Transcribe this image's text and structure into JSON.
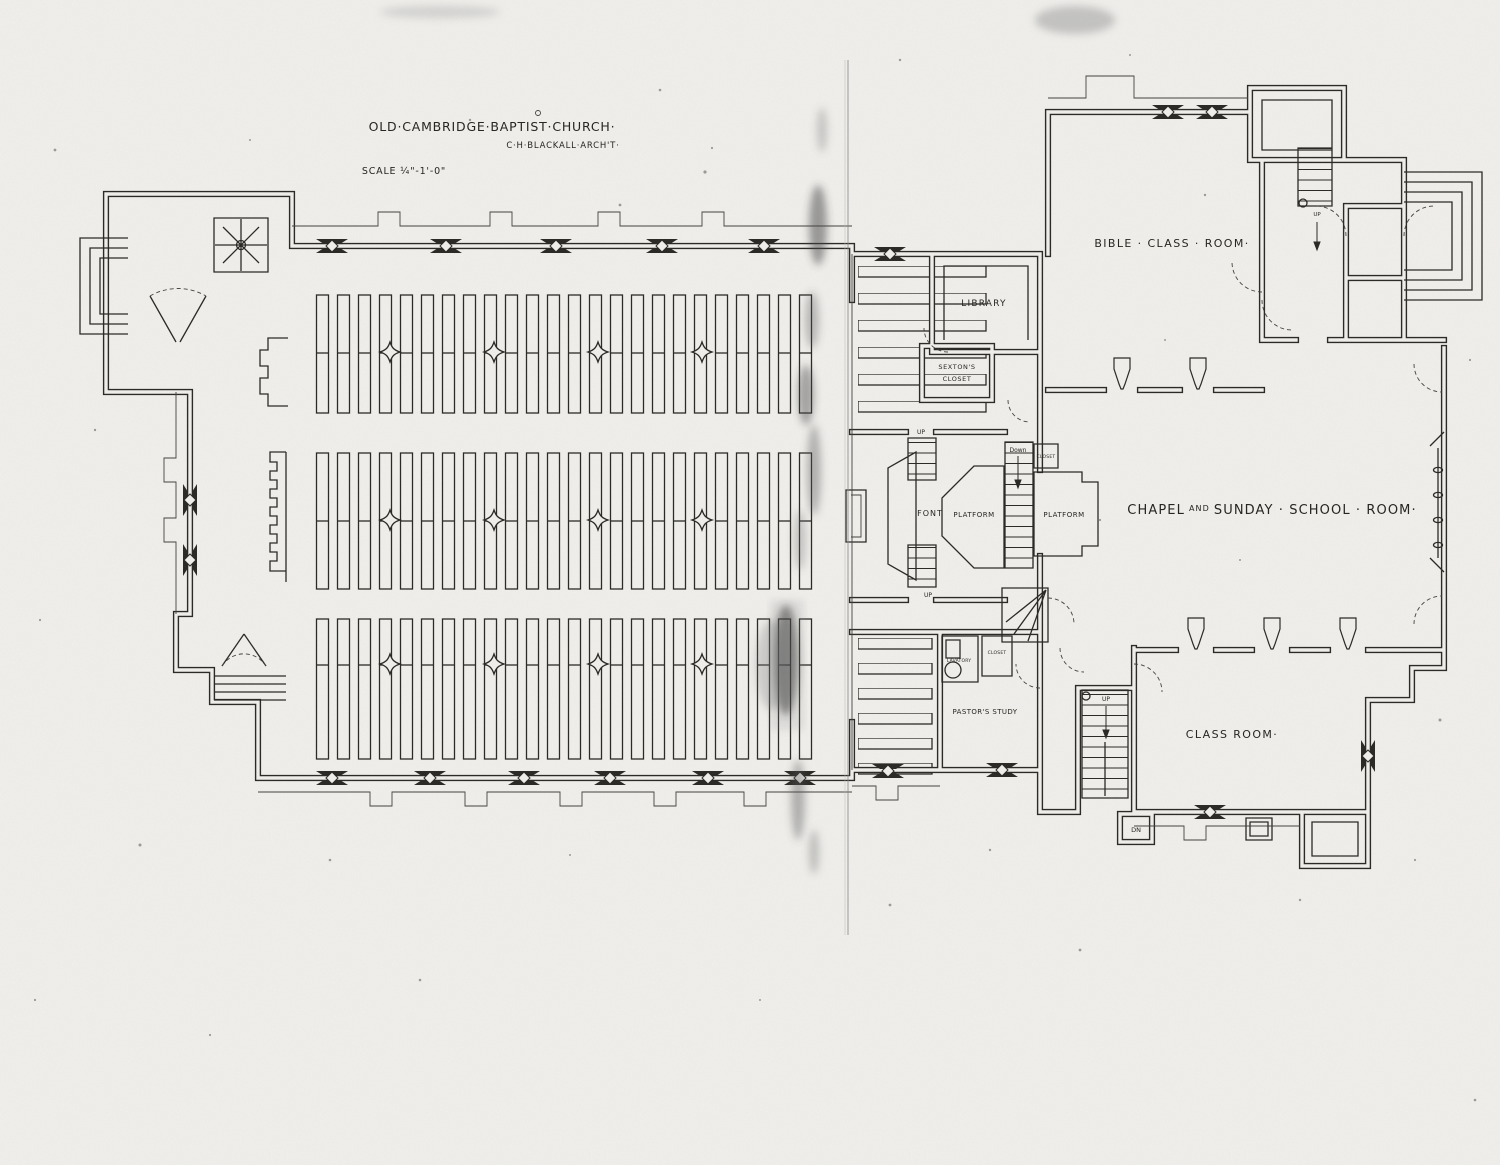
{
  "sheet": {
    "title": "OLD·CAMBRIDGE·BAPTIST·CHURCH·",
    "architect": "C·H·BLACKALL·ARCH'T·",
    "scale": "SCALE ¼\"-1'-0\""
  },
  "rooms": {
    "bible_class_room": "BIBLE · CLASS · ROOM·",
    "library": "LIBRARY",
    "sextons_closet_line1": "SEXTON'S",
    "sextons_closet_line2": "CLOSET",
    "font": "FONT",
    "platform_left": "PLATFORM",
    "platform_right": "PLATFORM",
    "chapel_word1": "CHAPEL",
    "chapel_word_and": "AND",
    "chapel_word2": "SUNDAY · SCHOOL · ROOM·",
    "pastors_study": "PASTOR'S STUDY",
    "class_room": "CLASS ROOM·",
    "lavatory": "LAVATORY",
    "closet_by_lavatory": "CLOSET",
    "closet_chancel": "CLOSET"
  },
  "stairs": {
    "up": "UP",
    "down": "Down",
    "dn": "DN"
  },
  "colors": {
    "paper": "#f1f0ed",
    "ink": "#2b2926"
  }
}
